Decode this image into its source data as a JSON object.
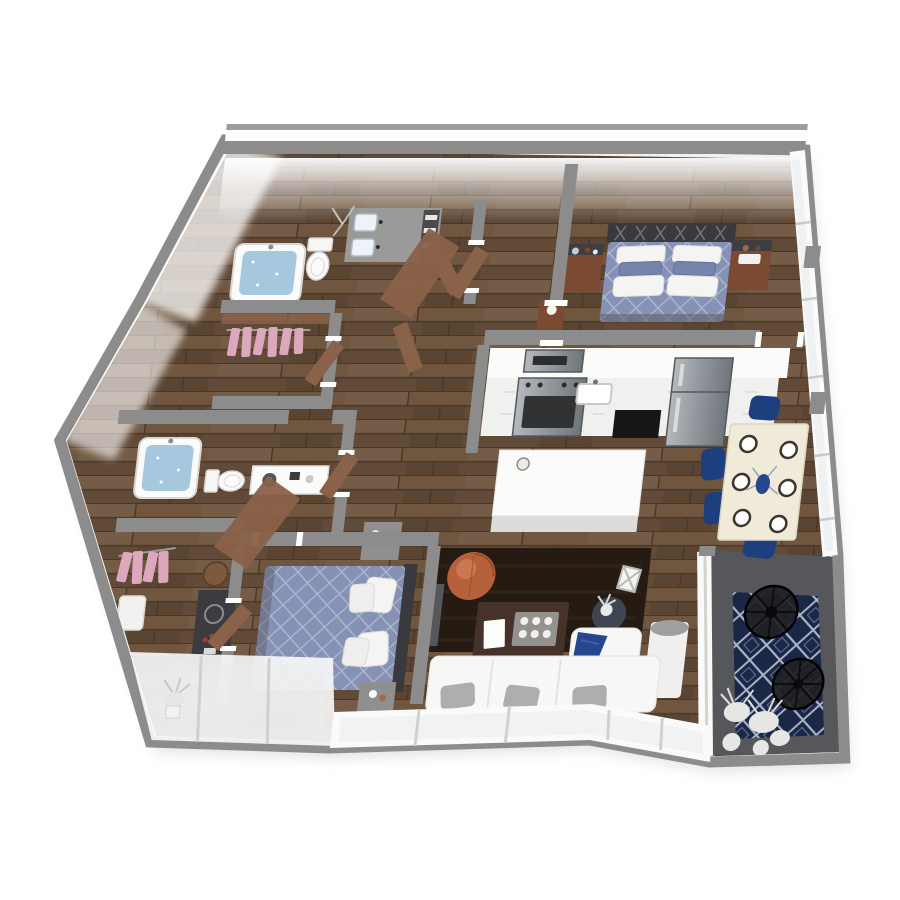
{
  "scene": {
    "type": "isometric-3d-floor-plan-render",
    "background": "#ffffff",
    "visible_text": []
  },
  "palette": {
    "wall_face": "#f2f1ef",
    "wall_top": "#8c8c8c",
    "wall_white": "#fbfbfa",
    "frame_white": "#fafafa",
    "wood_base": "#6b5140",
    "balcony_floor": "#55575a",
    "rug_navy": "#1a2747",
    "rug_living": "#261b13",
    "bed_blue": "#8591b5",
    "charcoal": "#3a3a3e",
    "water_blue": "#a5c8de",
    "clothes_pink": "#dba8bd",
    "chair_navy": "#1d3f7e",
    "table_cream": "#f0ead9",
    "pouf_orange": "#b6603c",
    "sofa_white": "#f7f7f5",
    "pillow_gray": "#aeaeac",
    "door_brown": "#8a6149",
    "counter_white": "#fbfbfa",
    "steel": "#8f959a",
    "steel_dark": "#5f6569",
    "appliance_black": "#161616",
    "nightstand_wood": "#7b4a33",
    "lamp_white": "#efefed",
    "side_table_dark": "#3e4550",
    "coffee_table_brown": "#46322a",
    "glass": "#e9ebec",
    "plant_white": "#e6e6e4",
    "dresser_dark": "#3c3c40",
    "stool_wood": "#7b5a40",
    "vanity_gray": "#9a9a98"
  },
  "inventory": {
    "rooms": [
      {
        "name": "bedroom-top-right",
        "items": [
          "metal-x-headboard",
          "queen-bed-blue-diamond-quilt",
          "white-pillows",
          "blue-shams",
          "wood-nightstand-left",
          "wood-nightstand-right",
          "decor-vases"
        ]
      },
      {
        "name": "bathroom-top",
        "items": [
          "bathtub-filled",
          "toilet",
          "double-vanity-two-sinks",
          "mirrors",
          "towel-shelf",
          "plant"
        ]
      },
      {
        "name": "walk-in-closet-upper-left",
        "items": [
          "pink-hanging-clothes"
        ]
      },
      {
        "name": "bathroom-left",
        "items": [
          "bathtub-filled",
          "toilet",
          "vanity-sink"
        ]
      },
      {
        "name": "closet-lower-left",
        "items": [
          "pink-hanging-clothes",
          "laundry-basket"
        ]
      },
      {
        "name": "bedroom-bottom-left",
        "items": [
          "queen-bed-blue-diamond-quilt",
          "white-pillows",
          "gray-nightstand-top",
          "gray-nightstand-bottom",
          "dark-dresser",
          "round-wood-stool",
          "wall-tv"
        ]
      },
      {
        "name": "kitchen",
        "items": [
          "white-counter-run",
          "microwave",
          "stainless-range-oven",
          "sink",
          "black-dishwasher-opening",
          "stainless-refrigerator",
          "white-island",
          "bowl"
        ]
      },
      {
        "name": "dining-area",
        "items": [
          "cream-dining-table",
          "six-place-settings",
          "centerpiece",
          "navy-chairs-x4"
        ]
      },
      {
        "name": "living-room",
        "items": [
          "dark-area-rug",
          "cognac-leather-pouf",
          "dark-coffee-table",
          "serving-tray",
          "white-book",
          "round-side-table",
          "white-flower-vase",
          "folding-chair",
          "white-armchair",
          "navy-throw-blanket",
          "white-cylinder-floor-lamp",
          "white-sofa-gray-pillows"
        ]
      },
      {
        "name": "balcony",
        "items": [
          "navy-trellis-outdoor-rug",
          "black-wire-chair-x2",
          "white-potted-plants"
        ]
      },
      {
        "name": "glazing",
        "items": [
          "south-window-wall",
          "right-window-wall",
          "glass-balcony-front"
        ]
      }
    ]
  }
}
